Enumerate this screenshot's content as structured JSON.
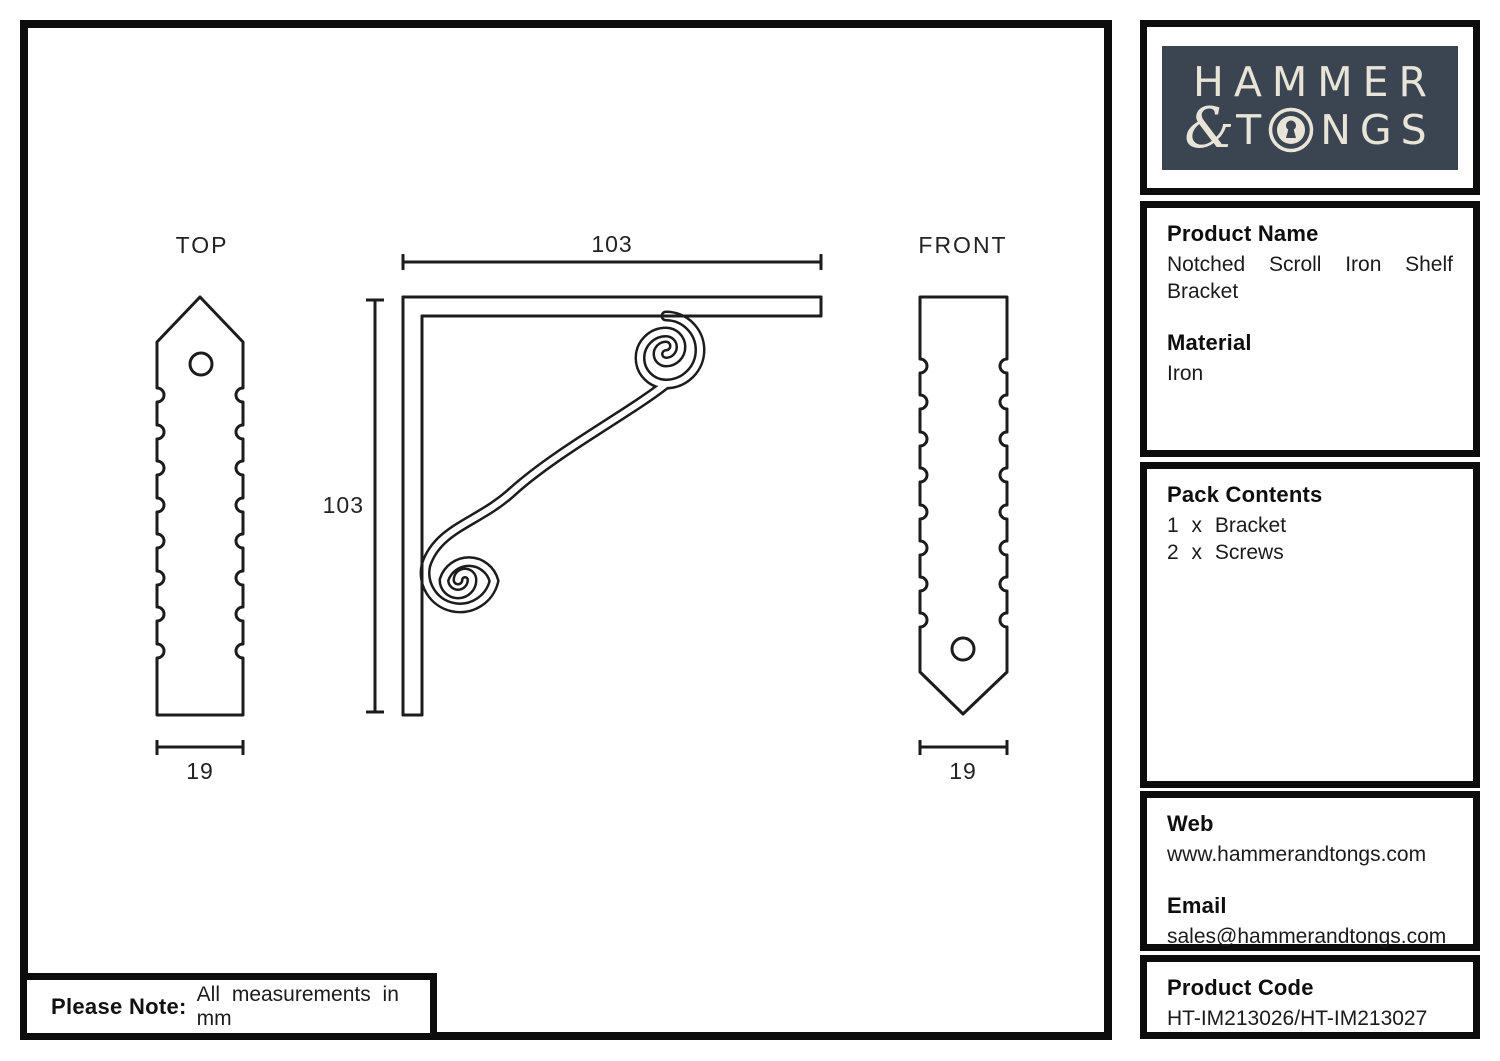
{
  "logo": {
    "word1": "HAMMER",
    "ampersand": "&",
    "word2_start": "T",
    "word2_end": "NGS",
    "keyhole_icon": "keyhole-in-letter-o",
    "bg_color": "#3b4552",
    "text_color": "#e9e4d8"
  },
  "sidebar": {
    "product_name_label": "Product Name",
    "product_name_value": "Notched Scroll Iron Shelf Bracket",
    "material_label": "Material",
    "material_value": "Iron",
    "pack_contents_label": "Pack Contents",
    "pack_contents_items": [
      "1 x Bracket",
      "2 x Screws"
    ],
    "web_label": "Web",
    "web_value": "www.hammerandtongs.com",
    "email_label": "Email",
    "email_value": "sales@hammerandtongs.com",
    "product_code_label": "Product Code",
    "product_code_value": "HT-IM213026/HT-IM213027"
  },
  "drawing": {
    "top_view_label": "TOP",
    "front_view_label": "FRONT",
    "bracket_width_mm": "103",
    "bracket_height_mm": "103",
    "top_view_width_mm": "19",
    "front_view_width_mm": "19"
  },
  "note": {
    "label": "Please Note:",
    "text": "All measurements in mm"
  },
  "colors": {
    "line": "#1c1c1c",
    "border": "#0c0c0c",
    "background": "#ffffff"
  }
}
